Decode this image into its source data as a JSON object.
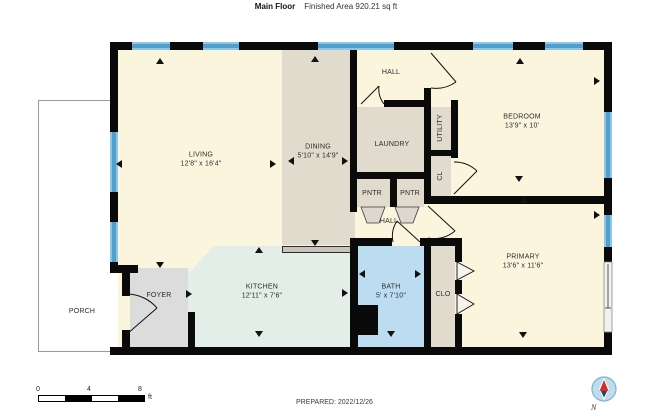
{
  "header": {
    "title": "Main Floor",
    "subtitle": "Finished Area 920.21 sq ft"
  },
  "rooms": {
    "living": {
      "label": "LIVING",
      "dims": "12'8\" x 16'4\""
    },
    "dining": {
      "label": "DINING",
      "dims": "5'10\" x 14'9\""
    },
    "hall_top": {
      "label": "HALL"
    },
    "laundry": {
      "label": "LAUNDRY"
    },
    "utility": {
      "label": "UTILITY"
    },
    "cl": {
      "label": "CL"
    },
    "bedroom": {
      "label": "BEDROOM",
      "dims": "13'9\" x 10'"
    },
    "pantry1": {
      "label": "PNTR"
    },
    "pantry2": {
      "label": "PNTR"
    },
    "hall_mid": {
      "label": "HALL"
    },
    "kitchen": {
      "label": "KITCHEN",
      "dims": "12'11\" x 7'6\""
    },
    "foyer": {
      "label": "FOYER"
    },
    "bath": {
      "label": "BATH",
      "dims": "5' x 7'10\""
    },
    "clo": {
      "label": "CLO"
    },
    "primary": {
      "label": "PRIMARY",
      "dims": "13'6\" x 11'6\""
    },
    "porch": {
      "label": "PORCH"
    }
  },
  "scale_bar": {
    "ticks": [
      "0",
      "4",
      "8"
    ],
    "unit": "ft"
  },
  "compass": {
    "label": "N"
  },
  "footer": {
    "prepared": "PREPARED: 2022/12/26"
  },
  "colors": {
    "wall": "#0a0a0a",
    "window": "#4FA0CE",
    "room_cream": "#FBF5DE",
    "room_beige": "#E1DBCE",
    "room_mint": "#E2EEE7",
    "room_bath": "#BBDCF1",
    "room_foyer": "#DCDCDC",
    "compass_needle": "#D92B2B"
  }
}
